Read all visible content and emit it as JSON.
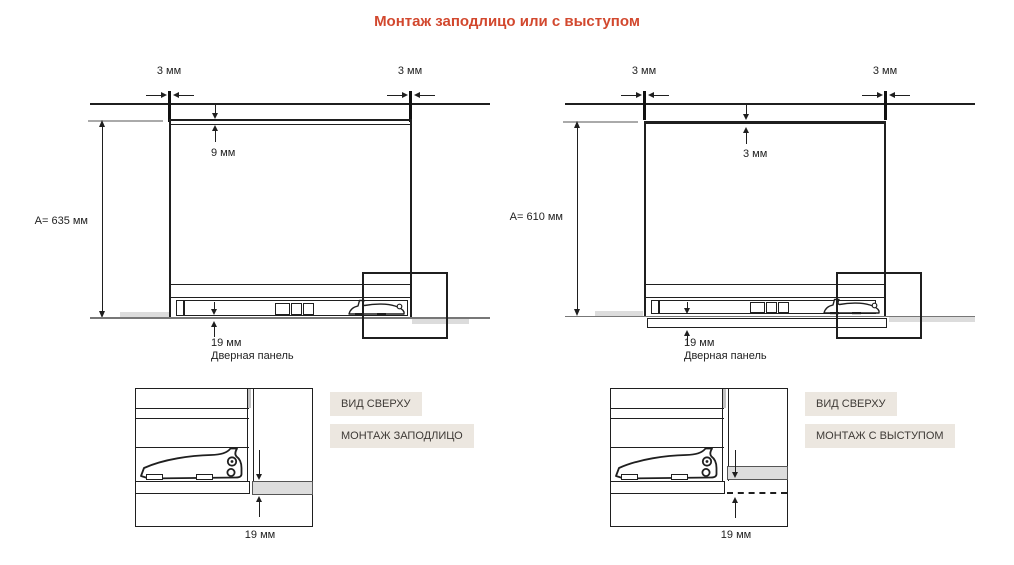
{
  "title": "Монтаж заподлицо или с выступом",
  "colors": {
    "accent": "#d2482e",
    "tag_background": "#ece7e0",
    "tag_text": "#3e3a36",
    "panel_gray": "#dcdcdc",
    "line": "#1f1f1f"
  },
  "left": {
    "dim_top_left": "3 мм",
    "dim_top_right": "3 мм",
    "dim_top_gap": "9 мм",
    "dim_height": "A= 635 мм",
    "dim_panel": "19 мм",
    "panel_caption": "Дверная панель",
    "detail_tag": "ВИД СВЕРХУ",
    "mount_tag": "МОНТАЖ ЗАПОДЛИЦО",
    "detail_dim": "19 мм"
  },
  "right": {
    "dim_top_left": "3 мм",
    "dim_top_right": "3 мм",
    "dim_top_gap": "3 мм",
    "dim_height": "A= 610 мм",
    "dim_panel": "19 мм",
    "panel_caption": "Дверная панель",
    "detail_tag": "ВИД СВЕРХУ",
    "mount_tag": "МОНТАЖ С ВЫСТУПОМ",
    "detail_dim": "19 мм"
  }
}
